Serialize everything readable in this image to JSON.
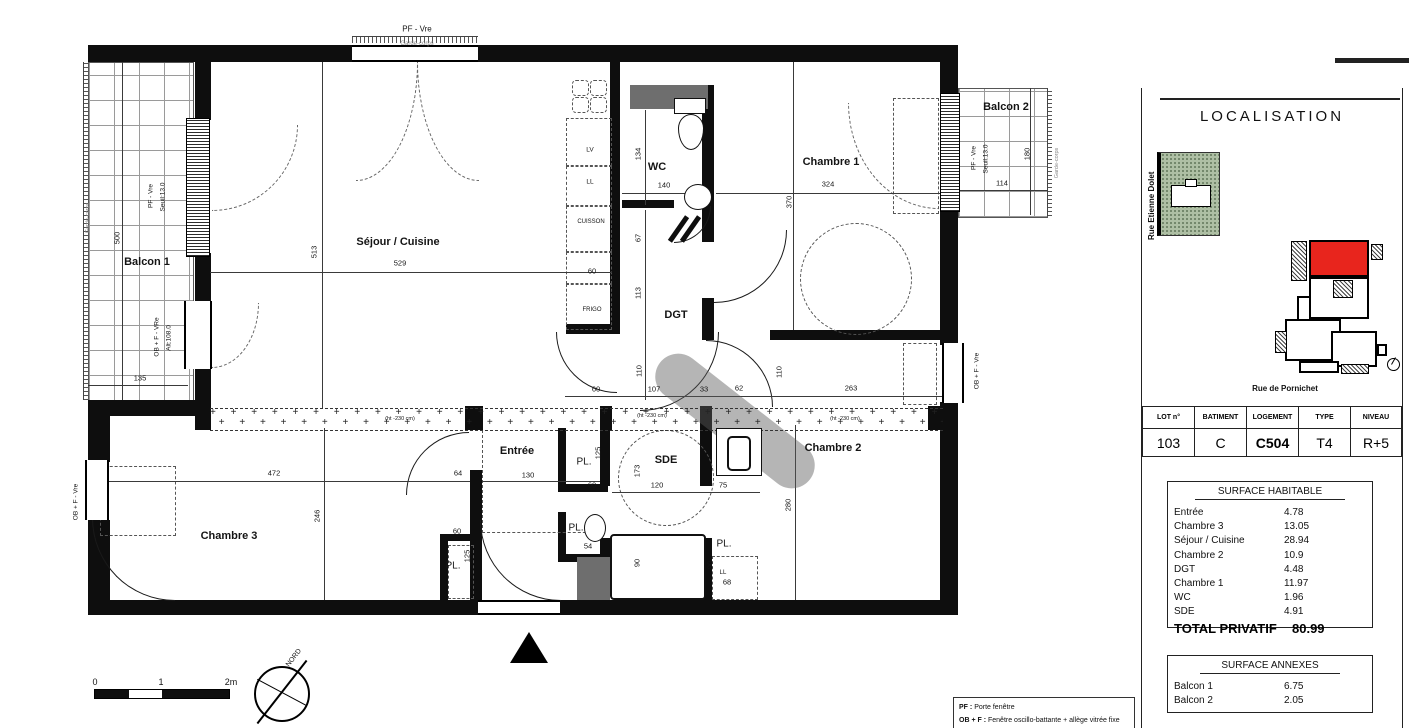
{
  "colors": {
    "accent_red": "#e8251d",
    "site_green": "#aebfa4",
    "wall_black": "#0e0e0e"
  },
  "right_panel": {
    "localisation_title": "LOCALISATION",
    "street_left": "Rue Etienne Dolet",
    "street_bottom": "Rue de Pornichet",
    "info_table": {
      "headers": [
        "LOT n°",
        "BATIMENT",
        "LOGEMENT",
        "TYPE",
        "NIVEAU"
      ],
      "values": [
        "103",
        "C",
        "C504",
        "T4",
        "R+5"
      ]
    },
    "surface_habitable": {
      "title": "SURFACE HABITABLE",
      "rows": [
        {
          "label": "Entrée",
          "value": "4.78"
        },
        {
          "label": "Chambre 3",
          "value": "13.05"
        },
        {
          "label": "Séjour / Cuisine",
          "value": "28.94"
        },
        {
          "label": "Chambre 2",
          "value": "10.9"
        },
        {
          "label": "DGT",
          "value": "4.48"
        },
        {
          "label": "Chambre 1",
          "value": "11.97"
        },
        {
          "label": "WC",
          "value": "1.96"
        },
        {
          "label": "SDE",
          "value": "4.91"
        }
      ],
      "total_label": "TOTAL PRIVATIF",
      "total_value": "80.99"
    },
    "surface_annexes": {
      "title": "SURFACE ANNEXES",
      "rows": [
        {
          "label": "Balcon 1",
          "value": "6.75"
        },
        {
          "label": "Balcon 2",
          "value": "2.05"
        }
      ]
    }
  },
  "legend": {
    "lines": [
      {
        "key": "PF :",
        "desc": "Porte fenêtre"
      },
      {
        "key": "OB + F :",
        "desc": "Fenêtre oscillo-battante + allège vitrée fixe"
      }
    ]
  },
  "plan": {
    "labels": [
      {
        "t": "Balcon 1",
        "x": 147,
        "y": 262,
        "s": 11,
        "b": 1,
        "k": "room-label-balcon1"
      },
      {
        "t": "Séjour / Cuisine",
        "x": 398,
        "y": 242,
        "s": 11,
        "b": 1,
        "k": "room-label-sejour-cuisine"
      },
      {
        "t": "WC",
        "x": 657,
        "y": 167,
        "s": 11,
        "b": 1,
        "k": "room-label-wc"
      },
      {
        "t": "Chambre 1",
        "x": 831,
        "y": 162,
        "s": 11,
        "b": 1,
        "k": "room-label-chambre1"
      },
      {
        "t": "Balcon 2",
        "x": 1006,
        "y": 107,
        "s": 11,
        "b": 1,
        "k": "room-label-balcon2"
      },
      {
        "t": "DGT",
        "x": 676,
        "y": 315,
        "s": 11,
        "b": 1,
        "k": "room-label-dgt"
      },
      {
        "t": "Chambre 2",
        "x": 833,
        "y": 448,
        "s": 11,
        "b": 1,
        "k": "room-label-chambre2"
      },
      {
        "t": "Chambre 3",
        "x": 229,
        "y": 536,
        "s": 11,
        "b": 1,
        "k": "room-label-chambre3"
      },
      {
        "t": "Entrée",
        "x": 517,
        "y": 451,
        "s": 11,
        "b": 1,
        "k": "room-label-entree"
      },
      {
        "t": "SDE",
        "x": 666,
        "y": 460,
        "s": 11,
        "b": 1,
        "k": "room-label-sde"
      },
      {
        "t": "PL.",
        "x": 584,
        "y": 462,
        "s": 10,
        "k": "closet-label"
      },
      {
        "t": "PL.",
        "x": 576,
        "y": 528,
        "s": 10,
        "k": "closet-label"
      },
      {
        "t": "PL.",
        "x": 724,
        "y": 544,
        "s": 10,
        "k": "closet-label"
      },
      {
        "t": "PL.",
        "x": 453,
        "y": 566,
        "s": 10,
        "k": "closet-label"
      },
      {
        "t": "500",
        "x": 117,
        "y": 238,
        "r": 1,
        "k": "dim-label"
      },
      {
        "t": "135",
        "x": 140,
        "y": 378,
        "k": "dim-label"
      },
      {
        "t": "513",
        "x": 314,
        "y": 252,
        "r": 1,
        "k": "dim-label"
      },
      {
        "t": "529",
        "x": 400,
        "y": 263,
        "k": "dim-label"
      },
      {
        "t": "324",
        "x": 828,
        "y": 184,
        "k": "dim-label"
      },
      {
        "t": "370",
        "x": 789,
        "y": 202,
        "r": 1,
        "k": "dim-label"
      },
      {
        "t": "114",
        "x": 1002,
        "y": 183,
        "k": "dim-label"
      },
      {
        "t": "180",
        "x": 1027,
        "y": 154,
        "r": 1,
        "k": "dim-label"
      },
      {
        "t": "134",
        "x": 638,
        "y": 154,
        "r": 1,
        "k": "dim-label"
      },
      {
        "t": "140",
        "x": 664,
        "y": 185,
        "k": "dim-label"
      },
      {
        "t": "67",
        "x": 638,
        "y": 238,
        "r": 1,
        "k": "dim-label"
      },
      {
        "t": "60",
        "x": 592,
        "y": 271,
        "k": "dim-label"
      },
      {
        "t": "113",
        "x": 638,
        "y": 293,
        "r": 1,
        "k": "dim-label"
      },
      {
        "t": "110",
        "x": 639,
        "y": 371,
        "r": 1,
        "k": "dim-label"
      },
      {
        "t": "60",
        "x": 596,
        "y": 389,
        "k": "dim-label"
      },
      {
        "t": "107",
        "x": 654,
        "y": 389,
        "k": "dim-label"
      },
      {
        "t": "33",
        "x": 704,
        "y": 389,
        "k": "dim-label"
      },
      {
        "t": "62",
        "x": 739,
        "y": 388,
        "k": "dim-label"
      },
      {
        "t": "110",
        "x": 779,
        "y": 372,
        "r": 1,
        "k": "dim-label"
      },
      {
        "t": "263",
        "x": 851,
        "y": 388,
        "k": "dim-label"
      },
      {
        "t": "280",
        "x": 788,
        "y": 505,
        "r": 1,
        "k": "dim-label"
      },
      {
        "t": "472",
        "x": 274,
        "y": 473,
        "k": "dim-label"
      },
      {
        "t": "246",
        "x": 317,
        "y": 516,
        "r": 1,
        "k": "dim-label"
      },
      {
        "t": "64",
        "x": 458,
        "y": 473,
        "k": "dim-label"
      },
      {
        "t": "60",
        "x": 457,
        "y": 531,
        "k": "dim-label"
      },
      {
        "t": "125",
        "x": 467,
        "y": 556,
        "r": 1,
        "k": "dim-label"
      },
      {
        "t": "130",
        "x": 528,
        "y": 475,
        "k": "dim-label"
      },
      {
        "t": "125",
        "x": 598,
        "y": 453,
        "r": 1,
        "k": "dim-label"
      },
      {
        "t": "60",
        "x": 592,
        "y": 485,
        "k": "dim-label"
      },
      {
        "t": "173",
        "x": 637,
        "y": 471,
        "r": 1,
        "k": "dim-label"
      },
      {
        "t": "120",
        "x": 657,
        "y": 485,
        "k": "dim-label"
      },
      {
        "t": "75",
        "x": 723,
        "y": 485,
        "k": "dim-label"
      },
      {
        "t": "54",
        "x": 588,
        "y": 546,
        "k": "dim-label"
      },
      {
        "t": "90",
        "x": 710,
        "y": 565,
        "r": 1,
        "k": "dim-label"
      },
      {
        "t": "68",
        "x": 727,
        "y": 582,
        "k": "dim-label"
      },
      {
        "t": "90",
        "x": 637,
        "y": 563,
        "r": 1,
        "k": "dim-label"
      },
      {
        "t": "PF - Vre",
        "x": 417,
        "y": 29,
        "s": 8,
        "k": "window-type-label"
      },
      {
        "t": "Garde-corps",
        "x": 417,
        "y": 44,
        "s": 6,
        "c": "gray",
        "k": "railing-label"
      },
      {
        "t": "PF - Vre",
        "x": 151,
        "y": 196,
        "r": 1,
        "s": 6.5,
        "k": "window-type-label"
      },
      {
        "t": "Seuil:13.0",
        "x": 163,
        "y": 197,
        "r": 1,
        "s": 6.5,
        "k": "window-type-label"
      },
      {
        "t": "OB + F - VRe",
        "x": 157,
        "y": 337,
        "r": 1,
        "s": 6.5,
        "k": "window-type-label"
      },
      {
        "t": "Alt:108.0",
        "x": 169,
        "y": 338,
        "r": 1,
        "s": 6.5,
        "k": "window-type-label"
      },
      {
        "t": "PF - Vre",
        "x": 974,
        "y": 158,
        "r": 1,
        "s": 6.5,
        "k": "window-type-label"
      },
      {
        "t": "Seuil:13.0",
        "x": 986,
        "y": 159,
        "r": 1,
        "s": 6.5,
        "k": "window-type-label"
      },
      {
        "t": "Garde-corps",
        "x": 1057,
        "y": 163,
        "r": 1,
        "s": 5.5,
        "c": "gray",
        "k": "railing-label"
      },
      {
        "t": "Garde-corps",
        "x": 88,
        "y": 218,
        "r": 1,
        "s": 5.5,
        "c": "gray",
        "k": "railing-label"
      },
      {
        "t": "OB + F - Vre",
        "x": 977,
        "y": 371,
        "r": 1,
        "s": 6.5,
        "k": "window-type-label"
      },
      {
        "t": "OB + F - Vre",
        "x": 76,
        "y": 502,
        "r": 1,
        "s": 6.5,
        "k": "window-type-label"
      },
      {
        "t": "LV",
        "x": 590,
        "y": 150,
        "s": 6.5,
        "k": "appliance-label-dishwasher"
      },
      {
        "t": "LL",
        "x": 590,
        "y": 182,
        "s": 6.5,
        "k": "appliance-label-washer"
      },
      {
        "t": "CUISSON",
        "x": 591,
        "y": 222,
        "s": 6,
        "k": "appliance-label-cooktop"
      },
      {
        "t": "FRIGO",
        "x": 592,
        "y": 310,
        "s": 6,
        "k": "appliance-label-fridge"
      },
      {
        "t": "LL",
        "x": 723,
        "y": 573,
        "s": 6,
        "k": "appliance-label-washer"
      },
      {
        "t": "(ht -230 cm)",
        "x": 400,
        "y": 419,
        "s": 5.5,
        "k": "ceiling-height-note"
      },
      {
        "t": "(ht -230 cm)",
        "x": 652,
        "y": 416,
        "s": 5.5,
        "k": "ceiling-height-note"
      },
      {
        "t": "(ht -230 cm)",
        "x": 845,
        "y": 419,
        "s": 5.5,
        "k": "ceiling-height-note"
      },
      {
        "t": "0",
        "x": 95,
        "y": 682,
        "s": 9,
        "k": "scale-tick-label"
      },
      {
        "t": "1",
        "x": 161,
        "y": 682,
        "s": 9,
        "k": "scale-tick-label"
      },
      {
        "t": "2m",
        "x": 231,
        "y": 682,
        "s": 9,
        "k": "scale-tick-label"
      },
      {
        "t": "NORD",
        "x": 294,
        "y": 658,
        "s": 7,
        "c": "nord",
        "k": "north-label"
      }
    ]
  }
}
